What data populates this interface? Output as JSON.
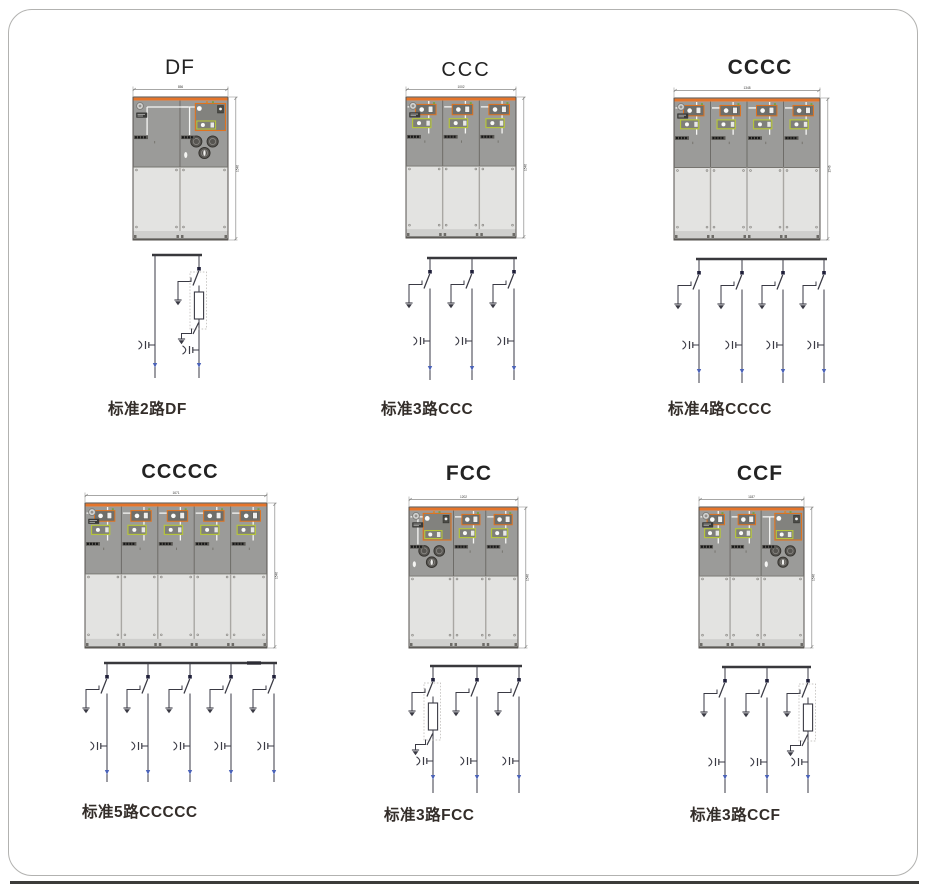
{
  "page": {
    "background": "#ffffff",
    "frame_border": "#b2b2b0"
  },
  "colors": {
    "accent_orange": "#e5752b",
    "mech_orange_border": "#e0731f",
    "mech_yellow_border": "#b5c43c",
    "cabinet_gray": "#9b9b99",
    "door_gray": "#e3e3e1",
    "circuit_line": "#3a3a44",
    "blue_marker": "#4a62b8"
  },
  "units": [
    {
      "id": "df",
      "title": "DF",
      "caption": "标准2路DF",
      "panels": [
        "D",
        "F"
      ],
      "width_dim": "856",
      "height_dim": "1546"
    },
    {
      "id": "ccc",
      "title": "CCC",
      "caption": "标准3路CCC",
      "panels": [
        "C",
        "C",
        "C"
      ],
      "width_dim": "1002",
      "height_dim": "1546"
    },
    {
      "id": "cccc",
      "title": "CCCC",
      "caption": "标准4路CCCC",
      "panels": [
        "C",
        "C",
        "C",
        "C"
      ],
      "width_dim": "1348",
      "height_dim": "1546"
    },
    {
      "id": "ccccc",
      "title": "CCCCC",
      "caption": "标准5路CCCCC",
      "panels": [
        "C",
        "C",
        "C",
        "C",
        "C"
      ],
      "width_dim": "1671",
      "height_dim": "1546"
    },
    {
      "id": "fcc",
      "title": "FCC",
      "caption": "标准3路FCC",
      "panels": [
        "F",
        "C",
        "C"
      ],
      "width_dim": "1202",
      "height_dim": "1546"
    },
    {
      "id": "ccf",
      "title": "CCF",
      "caption": "标准3路CCF",
      "panels": [
        "C",
        "C",
        "F"
      ],
      "width_dim": "1187",
      "height_dim": "1546"
    }
  ]
}
